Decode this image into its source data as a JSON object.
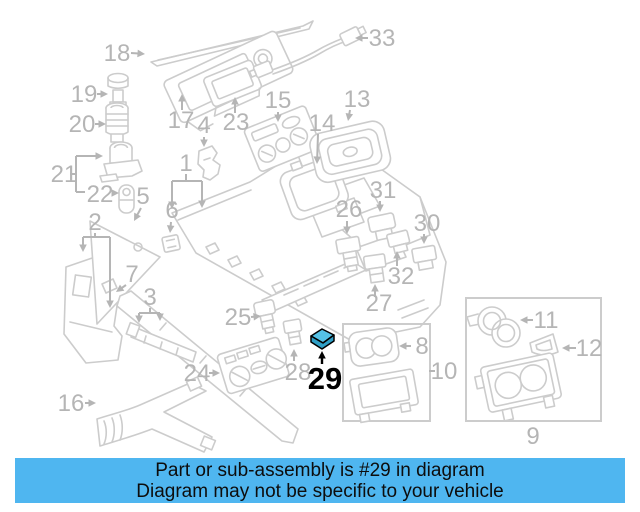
{
  "banner": {
    "line1": "Part or sub-assembly is #29 in diagram",
    "line2": "Diagram may not be specific to your vehicle",
    "background_color": "#4fb6f0",
    "text_color": "#0d0d0d"
  },
  "diagram": {
    "description": "Exploded parts diagram of a vehicle center console assembly",
    "highlighted_part": "29",
    "line_color": "#cccccc",
    "label_color": "#b5b5b5",
    "label_font_size": 24,
    "highlight_fill": "#55c2e6",
    "highlight_fill_dark": "#2f9fc6",
    "labels": [
      {
        "t": "18",
        "x": 117,
        "y": 61,
        "arrows": [
          [
            131,
            53,
            145,
            54
          ]
        ]
      },
      {
        "t": "19",
        "x": 84,
        "y": 102,
        "arrows": [
          [
            97,
            94,
            108,
            94
          ]
        ]
      },
      {
        "t": "20",
        "x": 82,
        "y": 132,
        "arrows": [
          [
            95,
            124,
            106,
            124
          ]
        ]
      },
      {
        "t": "21",
        "x": 64,
        "y": 182,
        "lines": [
          [
            70,
            174,
            76,
            174
          ],
          [
            76,
            156,
            76,
            192
          ],
          [
            76,
            192,
            85,
            192
          ]
        ],
        "arrows": [
          [
            76,
            156,
            103,
            156
          ]
        ]
      },
      {
        "t": "22",
        "x": 100,
        "y": 202,
        "arrows": [
          [
            112,
            193,
            119,
            193
          ]
        ]
      },
      {
        "t": "2",
        "x": 95,
        "y": 230,
        "lines": [
          [
            95,
            233,
            95,
            237
          ],
          [
            83,
            237,
            110,
            237
          ],
          [
            110,
            237,
            110,
            300
          ]
        ],
        "arrows": [
          [
            83,
            237,
            83,
            252
          ],
          [
            110,
            300,
            110,
            308
          ]
        ]
      },
      {
        "t": "5",
        "x": 143,
        "y": 204,
        "arrows": [
          [
            141,
            208,
            134,
            221
          ]
        ]
      },
      {
        "t": "6",
        "x": 172,
        "y": 218,
        "arrows": [
          [
            171,
            222,
            170,
            233
          ]
        ]
      },
      {
        "t": "7",
        "x": 132,
        "y": 282,
        "arrows": [
          [
            126,
            285,
            116,
            292
          ]
        ]
      },
      {
        "t": "3",
        "x": 150,
        "y": 305,
        "lines": [
          [
            150,
            308,
            150,
            313
          ],
          [
            139,
            313,
            160,
            313
          ]
        ],
        "arrows": [
          [
            139,
            313,
            139,
            323
          ],
          [
            160,
            313,
            160,
            321
          ]
        ]
      },
      {
        "t": "1",
        "x": 186,
        "y": 171,
        "lines": [
          [
            186,
            174,
            186,
            181
          ],
          [
            172,
            181,
            202,
            181
          ]
        ],
        "arrows": [
          [
            172,
            181,
            172,
            209
          ],
          [
            202,
            181,
            202,
            208
          ]
        ]
      },
      {
        "t": "4",
        "x": 204,
        "y": 133,
        "arrows": [
          [
            204,
            137,
            204,
            147
          ]
        ]
      },
      {
        "t": "17",
        "x": 181,
        "y": 128,
        "arrows": [
          [
            182,
            110,
            182,
            94
          ]
        ]
      },
      {
        "t": "23",
        "x": 236,
        "y": 130,
        "arrows": [
          [
            235,
            113,
            235,
            97
          ]
        ]
      },
      {
        "t": "15",
        "x": 278,
        "y": 108,
        "arrows": [
          [
            278,
            112,
            278,
            122
          ]
        ]
      },
      {
        "t": "14",
        "x": 322,
        "y": 131,
        "arrows": [
          [
            318,
            134,
            317,
            164
          ]
        ]
      },
      {
        "t": "13",
        "x": 357,
        "y": 107,
        "arrows": [
          [
            350,
            110,
            348,
            121
          ]
        ]
      },
      {
        "t": "33",
        "x": 382,
        "y": 46,
        "arrows": [
          [
            368,
            38,
            355,
            38
          ]
        ]
      },
      {
        "t": "26",
        "x": 349,
        "y": 217,
        "arrows": [
          [
            347,
            221,
            347,
            234
          ]
        ]
      },
      {
        "t": "31",
        "x": 383,
        "y": 198,
        "arrows": [
          [
            380,
            201,
            380,
            212
          ]
        ]
      },
      {
        "t": "30",
        "x": 427,
        "y": 231,
        "arrows": [
          [
            424,
            234,
            424,
            244
          ]
        ]
      },
      {
        "t": "32",
        "x": 401,
        "y": 284,
        "arrows": [
          [
            397,
            266,
            397,
            251
          ]
        ]
      },
      {
        "t": "27",
        "x": 379,
        "y": 311,
        "arrows": [
          [
            375,
            297,
            375,
            284
          ]
        ]
      },
      {
        "t": "25",
        "x": 238,
        "y": 325,
        "arrows": [
          [
            251,
            317,
            261,
            316
          ]
        ]
      },
      {
        "t": "24",
        "x": 197,
        "y": 381,
        "arrows": [
          [
            209,
            373,
            220,
            373
          ]
        ]
      },
      {
        "t": "28",
        "x": 298,
        "y": 380,
        "arrows": [
          [
            294,
            361,
            294,
            349
          ]
        ]
      },
      {
        "t": "29",
        "x": 325,
        "y": 389,
        "fs": 31,
        "bold": true,
        "color": "#000000",
        "ac": "#000000",
        "arrows": [
          [
            322,
            364,
            322,
            351
          ]
        ]
      },
      {
        "t": "8",
        "x": 422,
        "y": 354,
        "arrows": [
          [
            411,
            346,
            399,
            346
          ]
        ]
      },
      {
        "t": "10",
        "x": 444,
        "y": 379,
        "lines": [
          [
            429,
            371,
            435,
            371
          ]
        ]
      },
      {
        "t": "11",
        "x": 546,
        "y": 328,
        "arrows": [
          [
            533,
            320,
            520,
            320
          ]
        ]
      },
      {
        "t": "12",
        "x": 589,
        "y": 356,
        "arrows": [
          [
            576,
            348,
            562,
            348
          ]
        ]
      },
      {
        "t": "9",
        "x": 533,
        "y": 444
      },
      {
        "t": "16",
        "x": 71,
        "y": 411,
        "arrows": [
          [
            85,
            403,
            96,
            403
          ]
        ]
      }
    ]
  }
}
